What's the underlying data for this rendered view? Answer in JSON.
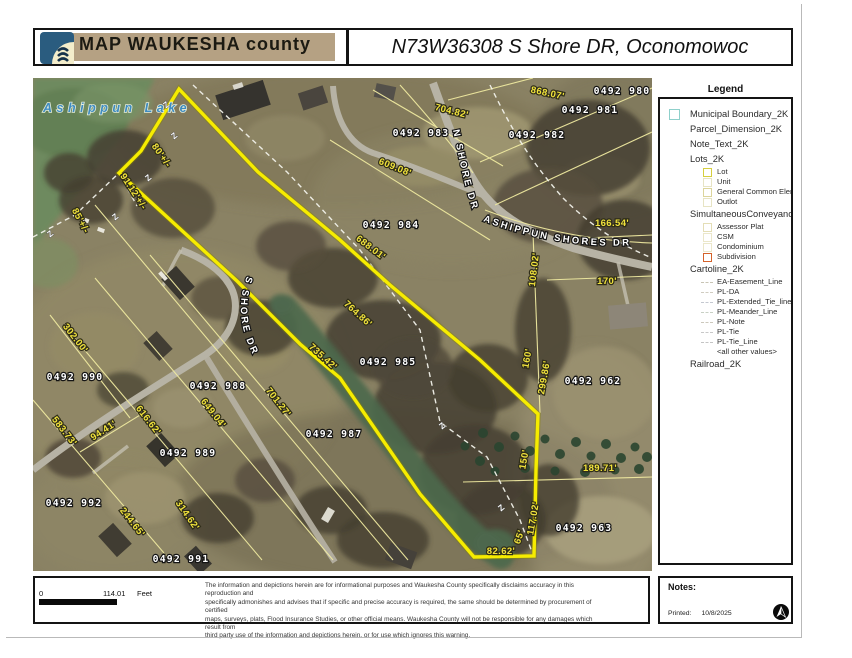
{
  "header": {
    "logo_text": "MAP WAUKESHA county",
    "title": "N73W36308 S Shore DR, Oconomowoc"
  },
  "legend": {
    "title": "Legend",
    "items": [
      {
        "label": "Municipal Boundary_2K",
        "swatch": "box",
        "color": "#8fd0cb",
        "indent": 0
      },
      {
        "label": "Parcel_Dimension_2K",
        "swatch": "none",
        "indent": 0
      },
      {
        "label": "Note_Text_2K",
        "swatch": "none",
        "indent": 0
      },
      {
        "label": "Lots_2K",
        "swatch": "none",
        "indent": 0
      },
      {
        "label": "Lot",
        "swatch": "box",
        "color": "#d6cf3e",
        "indent": 1
      },
      {
        "label": "Unit",
        "swatch": "box",
        "color": "#e7e4c4",
        "indent": 1
      },
      {
        "label": "General Common Element",
        "swatch": "box",
        "color": "#dcd59c",
        "indent": 1
      },
      {
        "label": "Outlot",
        "swatch": "box",
        "color": "#e7e4c4",
        "indent": 1
      },
      {
        "label": "SimultaneousConveyance",
        "swatch": "none",
        "indent": 0
      },
      {
        "label": "Assessor Plat",
        "swatch": "box",
        "color": "#e4deb6",
        "indent": 1
      },
      {
        "label": "CSM",
        "swatch": "box",
        "color": "#ebe7ca",
        "indent": 1
      },
      {
        "label": "Condominium",
        "swatch": "box",
        "color": "#ebe7ca",
        "indent": 1
      },
      {
        "label": "Subdivision",
        "swatch": "box",
        "color": "#d4622a",
        "indent": 1
      },
      {
        "label": "Cartoline_2K",
        "swatch": "none",
        "indent": 0
      },
      {
        "label": "EA-Easement_Line",
        "swatch": "line",
        "color": "#c8c4b4",
        "indent": 1
      },
      {
        "label": "PL-DA",
        "swatch": "line",
        "color": "#d0ccc0",
        "indent": 1
      },
      {
        "label": "PL-Extended_Tie_line",
        "swatch": "line",
        "color": "#c4c8d0",
        "indent": 1
      },
      {
        "label": "PL-Meander_Line",
        "swatch": "line",
        "color": "#c8d0c4",
        "indent": 1
      },
      {
        "label": "PL-Note",
        "swatch": "line",
        "color": "#ccc8bc",
        "indent": 1
      },
      {
        "label": "PL-Tie",
        "swatch": "line",
        "color": "#c8c8c8",
        "indent": 1
      },
      {
        "label": "PL-Tie_Line",
        "swatch": "line",
        "color": "#c4c4c4",
        "indent": 1
      },
      {
        "label": "<all other values>",
        "swatch": "none",
        "indent": 1
      },
      {
        "label": "Railroad_2K",
        "swatch": "none",
        "indent": 0
      }
    ]
  },
  "map": {
    "lake_label": {
      "text": "Ashippun Lake",
      "x": 10,
      "y": 34
    },
    "road_labels": [
      {
        "text": "N SHORE DR",
        "path": "rp0"
      },
      {
        "text": "ASHIPPUN SHORES DR",
        "path": "rp1"
      },
      {
        "text": "S SHORE DR",
        "path": "rp2"
      }
    ],
    "parcel_labels": [
      {
        "text": "0492 980",
        "x": 589,
        "y": 16
      },
      {
        "text": "0492 981",
        "x": 557,
        "y": 35
      },
      {
        "text": "0492 982",
        "x": 504,
        "y": 60
      },
      {
        "text": "0492 983",
        "x": 388,
        "y": 58
      },
      {
        "text": "0492 984",
        "x": 358,
        "y": 150
      },
      {
        "text": "0492 985",
        "x": 355,
        "y": 287
      },
      {
        "text": "0492 987",
        "x": 301,
        "y": 359
      },
      {
        "text": "0492 988",
        "x": 185,
        "y": 311
      },
      {
        "text": "0492 989",
        "x": 155,
        "y": 378
      },
      {
        "text": "0492 990",
        "x": 42,
        "y": 302
      },
      {
        "text": "0492 991",
        "x": 148,
        "y": 484
      },
      {
        "text": "0492 992",
        "x": 41,
        "y": 428
      },
      {
        "text": "0492 962",
        "x": 560,
        "y": 306
      },
      {
        "text": "0492 963",
        "x": 551,
        "y": 453
      }
    ],
    "dimension_labels": [
      {
        "text": "868.07'",
        "x": 514,
        "y": 18,
        "r": 12
      },
      {
        "text": "704.82'",
        "x": 418,
        "y": 36,
        "r": 14
      },
      {
        "text": "609.08'",
        "x": 361,
        "y": 92,
        "r": 22
      },
      {
        "text": "688.01'",
        "x": 336,
        "y": 172,
        "r": 37
      },
      {
        "text": "166.54'",
        "x": 579,
        "y": 148,
        "r": 0
      },
      {
        "text": "170'",
        "x": 574,
        "y": 206,
        "r": 0
      },
      {
        "text": "108.02'",
        "x": 504,
        "y": 192,
        "r": -83
      },
      {
        "text": "160'",
        "x": 497,
        "y": 281,
        "r": -80
      },
      {
        "text": "299.86'",
        "x": 514,
        "y": 300,
        "r": -80
      },
      {
        "text": "764.86'",
        "x": 323,
        "y": 238,
        "r": 42
      },
      {
        "text": "735.42'",
        "x": 288,
        "y": 281,
        "r": 42
      },
      {
        "text": "701.27'",
        "x": 243,
        "y": 326,
        "r": 52
      },
      {
        "text": "649.04'",
        "x": 178,
        "y": 337,
        "r": 52
      },
      {
        "text": "616.62'",
        "x": 113,
        "y": 344,
        "r": 52
      },
      {
        "text": "583.73'",
        "x": 29,
        "y": 355,
        "r": 52
      },
      {
        "text": "302.00'",
        "x": 40,
        "y": 262,
        "r": 52
      },
      {
        "text": "94.41'",
        "x": 72,
        "y": 355,
        "r": -33
      },
      {
        "text": "244.65'",
        "x": 97,
        "y": 446,
        "r": 52
      },
      {
        "text": "314.62'",
        "x": 152,
        "y": 439,
        "r": 55
      },
      {
        "text": "91.12'+/-",
        "x": 98,
        "y": 115,
        "r": 57
      },
      {
        "text": "80'+/-",
        "x": 126,
        "y": 79,
        "r": 55
      },
      {
        "text": "85'+/-",
        "x": 45,
        "y": 144,
        "r": 62
      },
      {
        "text": "82.62'",
        "x": 468,
        "y": 476,
        "r": 0
      },
      {
        "text": "117.02'",
        "x": 503,
        "y": 441,
        "r": -80
      },
      {
        "text": "65'",
        "x": 489,
        "y": 460,
        "r": -70
      },
      {
        "text": "150'",
        "x": 494,
        "y": 382,
        "r": -80
      },
      {
        "text": "189.71'",
        "x": 567,
        "y": 393,
        "r": 0
      }
    ],
    "meander_marks": [
      {
        "x": 135,
        "y": 29
      },
      {
        "x": 143,
        "y": 60
      },
      {
        "x": 117,
        "y": 102
      },
      {
        "x": 84,
        "y": 141
      },
      {
        "x": 19,
        "y": 158
      },
      {
        "x": 411,
        "y": 350
      },
      {
        "x": 470,
        "y": 432
      }
    ]
  },
  "footer": {
    "scale": {
      "zero": "0",
      "value": "114.01",
      "unit": "Feet"
    },
    "disclaimer_lines": [
      "The information and depictions herein are for informational purposes and Waukesha County specifically disclaims accuracy in this reproduction and",
      "specifically admonishes and advises that if specific and precise accuracy is required, the same should be determined by procurement of certified",
      "maps, surveys, plats, Flood Insurance Studies, or other official means. Waukesha County will not be responsible for any damages which result from",
      "third party use of the information and depictions herein, or for use which ignores this warning."
    ],
    "notes_label": "Notes:",
    "printed_label": "Printed:",
    "printed_date": "10/8/2025"
  }
}
